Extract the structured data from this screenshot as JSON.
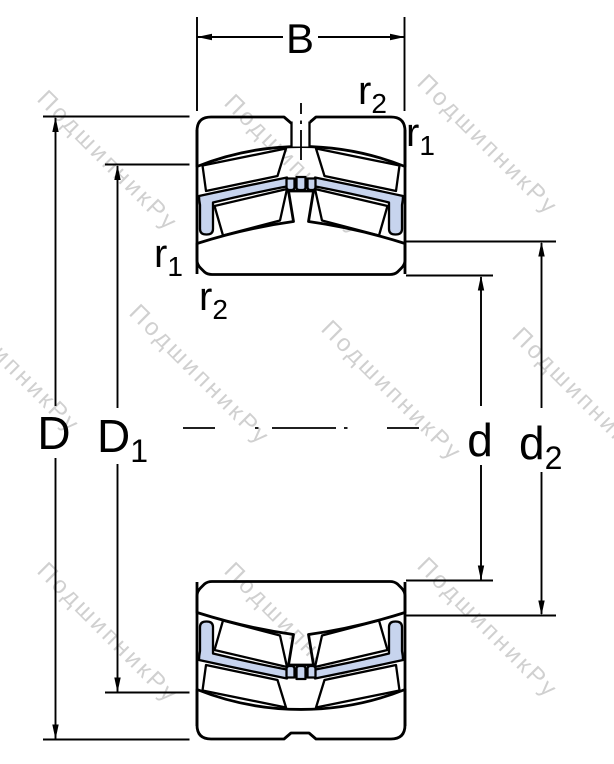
{
  "drawing": {
    "kind": "spherical-roller-bearing-cross-section",
    "colors": {
      "ring_fill": "#c7d4ee",
      "outline": "#000000",
      "background": "#ffffff",
      "watermark": "#d0d0d0"
    },
    "watermark": {
      "text": "ПодшипникРу"
    },
    "dim_labels": {
      "B": "B",
      "D": "D",
      "D1_main": "D",
      "D1_sub": "1",
      "d": "d",
      "d2_main": "d",
      "d2_sub": "2",
      "r1_main": "r",
      "r1_sub": "1",
      "r2_main": "r",
      "r2_sub": "2"
    }
  }
}
